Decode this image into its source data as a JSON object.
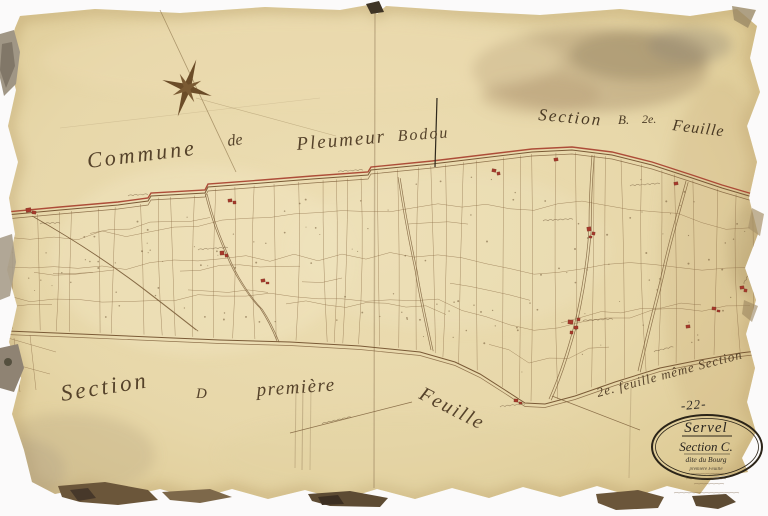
{
  "labels": {
    "commune_title": [
      "Commune",
      "de",
      "Pleumeur",
      "Bodou"
    ],
    "section_top_right": [
      "Section",
      "B.",
      "2e.",
      "Feuille"
    ],
    "section_bottom_left": [
      "Section",
      "D",
      "première",
      "Feuille"
    ],
    "adjacent_sheet_note": "2e. feuille même Section",
    "sheet_number": "-22-"
  },
  "cartouche": {
    "title": "Servel",
    "section": "Section C.",
    "subtitle": "dite du Bourg",
    "detail": "première Feuille"
  },
  "colors": {
    "paper": "#e8d8ab",
    "boundary_red": "#a63d2b",
    "map_line": "#8a6b45",
    "building_red": "#a8392b",
    "ink": "#55422a"
  }
}
